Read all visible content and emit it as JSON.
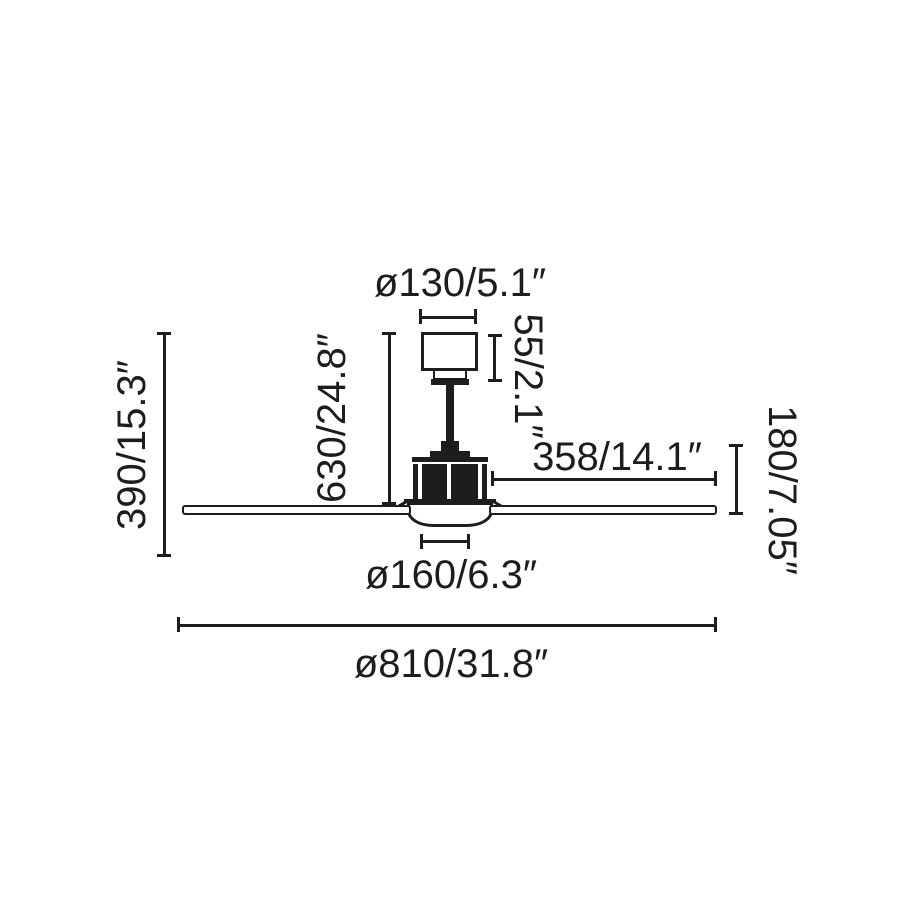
{
  "page": {
    "background": "#ffffff"
  },
  "diagram": {
    "kind": "ceiling-fan-dimension-drawing",
    "ink_color": "#1d1d1b",
    "labels": {
      "canopy_diameter": "ø130/5.1″",
      "canopy_height": "55/2.1″",
      "suspension_height": "630/24.8″",
      "total_height": "390/15.3″",
      "blade_length": "358/14.1″",
      "body_height": "180/7.05″",
      "light_diameter": "ø160/6.3″",
      "fan_diameter": "ø810/31.8″"
    }
  }
}
